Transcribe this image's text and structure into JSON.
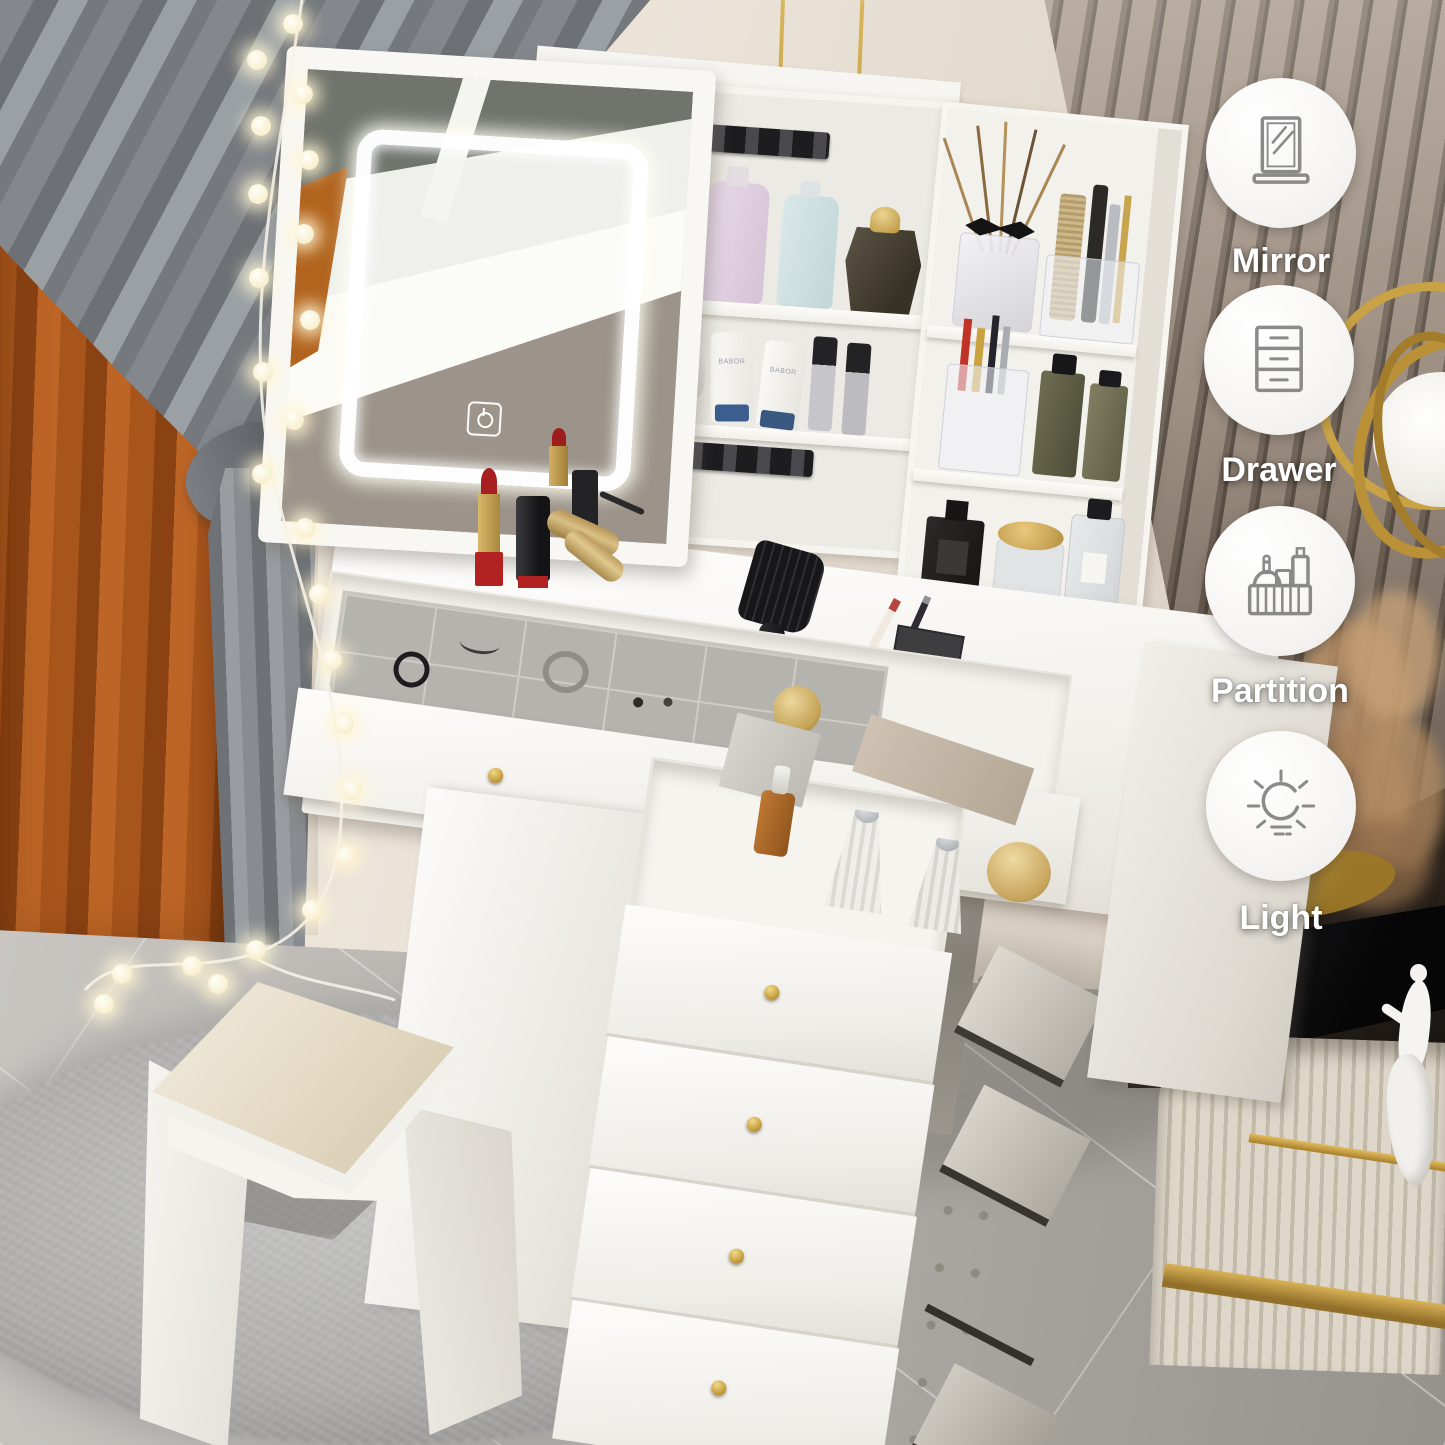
{
  "badges": [
    {
      "icon": "mirror-icon",
      "label": "Mirror"
    },
    {
      "icon": "drawer-icon",
      "label": "Drawer"
    },
    {
      "icon": "partition-icon",
      "label": "Partition"
    },
    {
      "icon": "light-icon",
      "label": "Light"
    }
  ],
  "products": {
    "tube_label": "BABOR"
  },
  "colors": {
    "accent_gold": "#c9a245",
    "badge_icon_stroke": "#8a8a8a",
    "badge_background": "#f7f6f4",
    "label_text": "#ffffff",
    "furniture_white": "#f6f4ef",
    "led_glow": "#ffffff"
  }
}
